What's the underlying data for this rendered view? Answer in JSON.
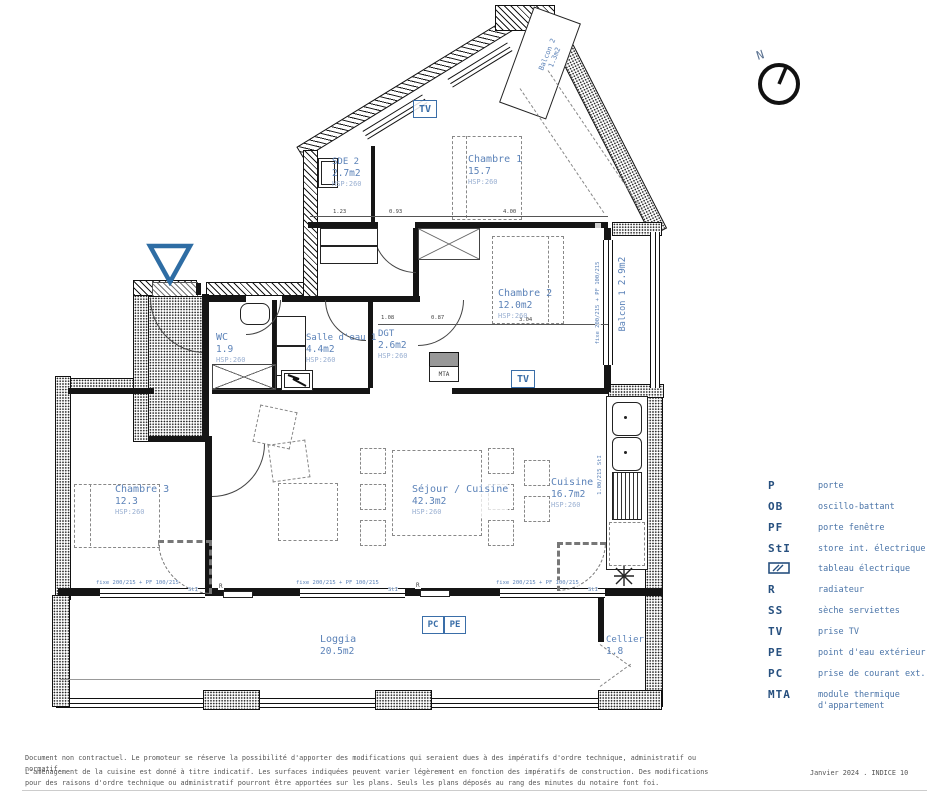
{
  "plan": {
    "rooms": {
      "sde2": {
        "name": "SDE 2",
        "area": "2.7m2",
        "hsp": "HSP:260"
      },
      "chambre1": {
        "name": "Chambre 1",
        "area": "15.7",
        "hsp": "HSP:260"
      },
      "chambre2": {
        "name": "Chambre 2",
        "area": "12.0m2",
        "hsp": "HSP:260"
      },
      "wc": {
        "name": "WC",
        "area": "1.9",
        "hsp": "HSP:260"
      },
      "salle_eau1": {
        "name": "Salle d'eau 1",
        "area": "4.4m2",
        "hsp": "HSP:260"
      },
      "dgt": {
        "name": "DGT",
        "area": "2.6m2",
        "hsp": "HSP:260"
      },
      "chambre3": {
        "name": "Chambre 3",
        "area": "12.3",
        "hsp": "HSP:260"
      },
      "sejour": {
        "name": "Séjour / Cuisine",
        "area": "42.3m2",
        "hsp": "HSP:260"
      },
      "cuisine": {
        "name": "Cuisine",
        "area": "16.7m2",
        "hsp": "HSP:260"
      },
      "loggia": {
        "name": "Loggia",
        "area": "20.5m2"
      },
      "cellier": {
        "name": "Cellier",
        "area": "1.8"
      },
      "balcon1": {
        "name": "Balcon 1",
        "area": "2.9m2"
      },
      "balcon2": {
        "name": "Balcon 2",
        "area": "1.3m2"
      }
    },
    "markers": {
      "tv": "TV",
      "pc": "PC",
      "pe": "PE",
      "mta": "MTA",
      "radiator": "R",
      "sti": "StI"
    },
    "windows": {
      "large": "fixe 200/215 + PF 100/215",
      "small": "1.00/215"
    },
    "dims": {
      "d1": "1.23",
      "d2": "0.93",
      "d3": "4.00",
      "d4": "1.08",
      "d5": "0.87",
      "d6": "3.04"
    },
    "compass_north": "N"
  },
  "legend": {
    "items": [
      {
        "code": "P",
        "label": "porte"
      },
      {
        "code": "OB",
        "label": "oscillo-battant"
      },
      {
        "code": "PF",
        "label": "porte fenêtre"
      },
      {
        "code": "StI",
        "label": "store int. électrique"
      },
      {
        "code": "",
        "label": "tableau électrique"
      },
      {
        "code": "R",
        "label": "radiateur"
      },
      {
        "code": "SS",
        "label": "sèche serviettes"
      },
      {
        "code": "TV",
        "label": "prise TV"
      },
      {
        "code": "PE",
        "label": "point d'eau extérieur"
      },
      {
        "code": "PC",
        "label": "prise de courant ext."
      },
      {
        "code": "MTA",
        "label": "module thermique d'appartement"
      }
    ]
  },
  "footer": {
    "line1": "Document non contractuel. Le promoteur se réserve la possibilité d'apporter des modifications qui seraient dues à des impératifs d'ordre technique, administratif ou normatif.",
    "line2": "L'aménagement de la cuisine est donné à titre indicatif. Les surfaces indiquées peuvent varier légèrement en fonction des impératifs de construction. Des modifications pour des raisons d'ordre technique ou administratif pourront être apportées sur les plans. Seuls les plans déposés au rang des minutes du notaire font foi.",
    "date": "Janvier 2024 . INDICE 10"
  },
  "colors": {
    "accent": "#2e6da4",
    "room_label": "#5b82b8",
    "legend_code": "#27507f",
    "legend_text": "#4a74a8",
    "wall": "#1a1a1a",
    "muted": "#555555"
  }
}
